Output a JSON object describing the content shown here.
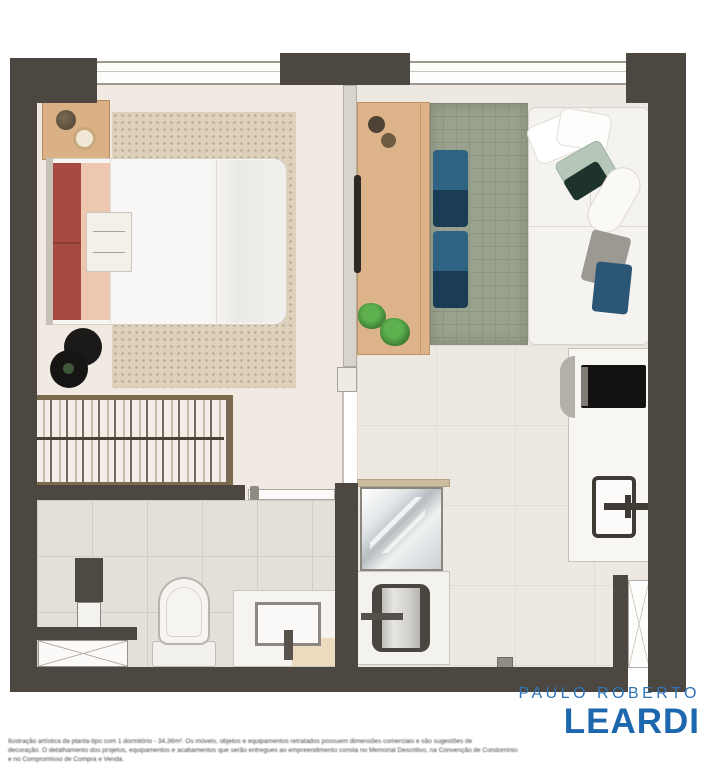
{
  "brand": {
    "top_line": "PAULO ROBERTO",
    "name": "LEARDI",
    "color": "#1d67ae"
  },
  "disclaimer": {
    "legibility": "blurred-fine-print",
    "line1": "Ilustração artística da planta-tipo com 1 dormitório - 34,36m². Os móveis, objetos e equipamentos retratados possuem dimensões comerciais e são sugestões de",
    "line2": "decoração. O detalhamento dos projetos, equipamentos e acabamentos que serão entregues ao empreendimento consta no Memorial Descritivo, na Convenção de Condomínio",
    "line3": "e no Compromisso de Compra e Venda."
  },
  "plan": {
    "type": "apartment-floor-plan",
    "wall_color": "#4d4741",
    "rooms": [
      {
        "name": "bedroom"
      },
      {
        "name": "living-room"
      },
      {
        "name": "kitchen"
      },
      {
        "name": "bathroom"
      },
      {
        "name": "laundry-shower-room"
      },
      {
        "name": "closet"
      },
      {
        "name": "hall"
      }
    ],
    "furniture": [
      "double-bed",
      "nightstand",
      "black-pouf",
      "wardrobe-with-hangers",
      "bathroom-door",
      "storage-column",
      "crosshatch-cabinet",
      "toilet",
      "vanity-sink",
      "shower-glass-box",
      "laundry-sink",
      "kitchen-counter",
      "cooktop",
      "kitchen-sink",
      "entry-door",
      "wood-desk-sideboard",
      "plants",
      "bedroom-rug",
      "living-rug",
      "floor-cushions",
      "corner-sofa"
    ]
  }
}
